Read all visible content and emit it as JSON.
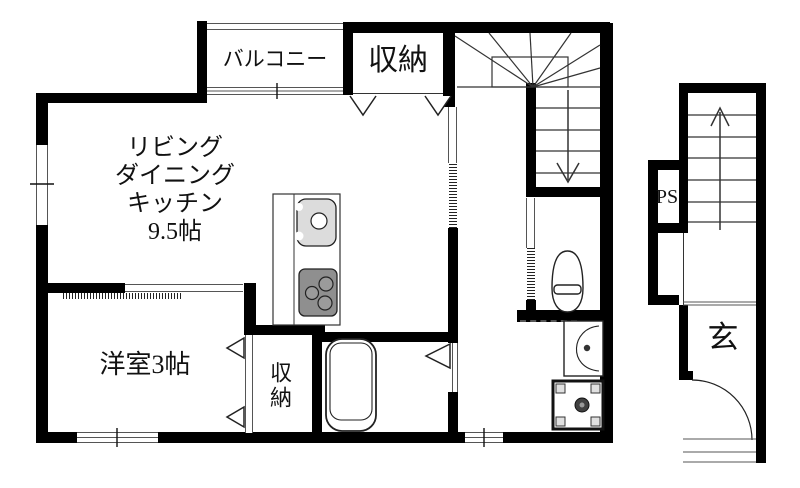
{
  "plan": {
    "title": "1LDK floor plan",
    "rooms": {
      "balcony": "バルコニー",
      "storage_top": "収納",
      "ldk": [
        "リビング",
        "ダイニング",
        "キッチン",
        "9.5帖"
      ],
      "western_room": "洋室3帖",
      "storage_bottom": "収納",
      "pipe_space": "PS",
      "entrance": "玄"
    },
    "colors": {
      "wall": "#000000",
      "background": "#ffffff",
      "fixture_gray": "#dcdcdc",
      "stove_gray": "#8f8f8f"
    }
  }
}
